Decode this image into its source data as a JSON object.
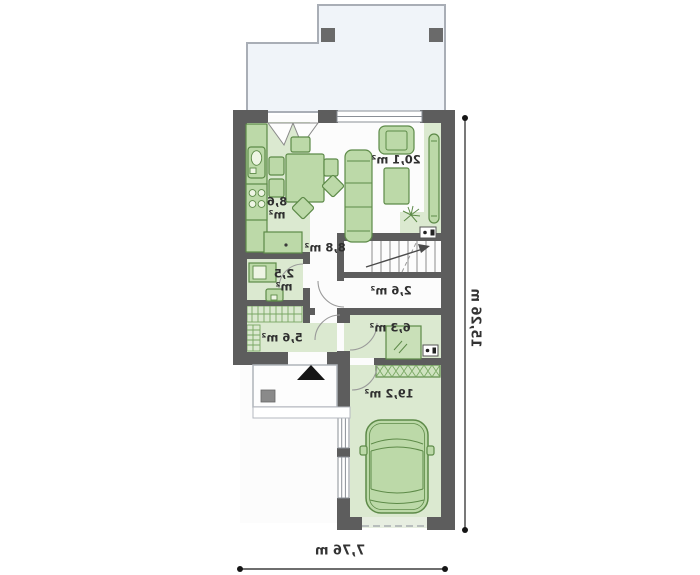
{
  "plan": {
    "type": "floor-plan-mirrored",
    "rooms": {
      "living": {
        "area": "20,1 m²"
      },
      "kitchen": {
        "area": "8,6 m²"
      },
      "hall": {
        "area": "8,8 m²"
      },
      "wc": {
        "area": "2,5 m²"
      },
      "vestibule": {
        "area": "2,6 m²"
      },
      "utility": {
        "area": "6,3 m²"
      },
      "corridor": {
        "area": "5,6 m²"
      },
      "garage": {
        "area": "19,2 m²"
      }
    },
    "dimensions": {
      "overall_width": "7,76 m",
      "overall_height": "15,26 m"
    },
    "colors": {
      "wall": "#5d5d5d",
      "room_fill": "#dbe9d0",
      "furniture_fill": "#bcd9a8",
      "furniture_stroke": "#5d8a48",
      "terrace_fill": "#f0f4f9",
      "dimension": "#3f3f3f"
    }
  }
}
